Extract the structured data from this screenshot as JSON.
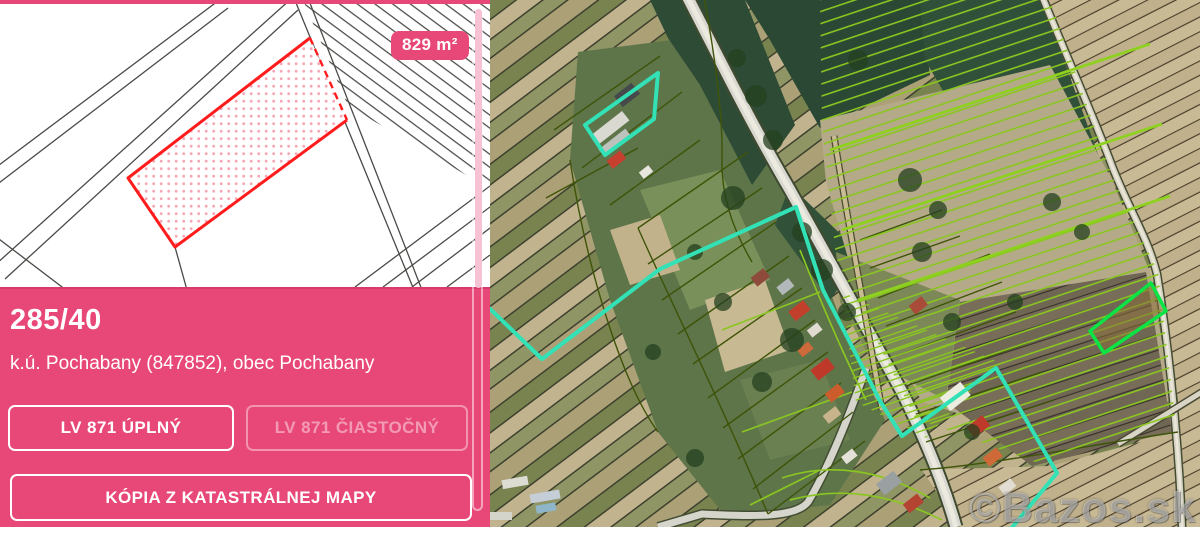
{
  "left_panel": {
    "area_badge": "829 m²",
    "parcel_number": "285/40",
    "parcel_location": "k.ú. Pochabany (847852), obec Pochabany",
    "button_lv_full": "LV 871 ÚPLNÝ",
    "button_lv_partial": "LV 871 ČIASTOČNÝ",
    "button_map_copy": "KÓPIA Z KATASTRÁLNEJ MAPY"
  },
  "map": {
    "watermark": "©Bazos.sk"
  },
  "colors": {
    "brand_pink": "#e84878",
    "scrollbar_pink": "#f8c2d5",
    "parcel_red": "#ff1c1c",
    "overlay_teal": "#32e2b6",
    "overlay_chartreuse": "#8ac621",
    "overlay_bright_green": "#0ce344",
    "overlay_olive": "#3e5408"
  }
}
